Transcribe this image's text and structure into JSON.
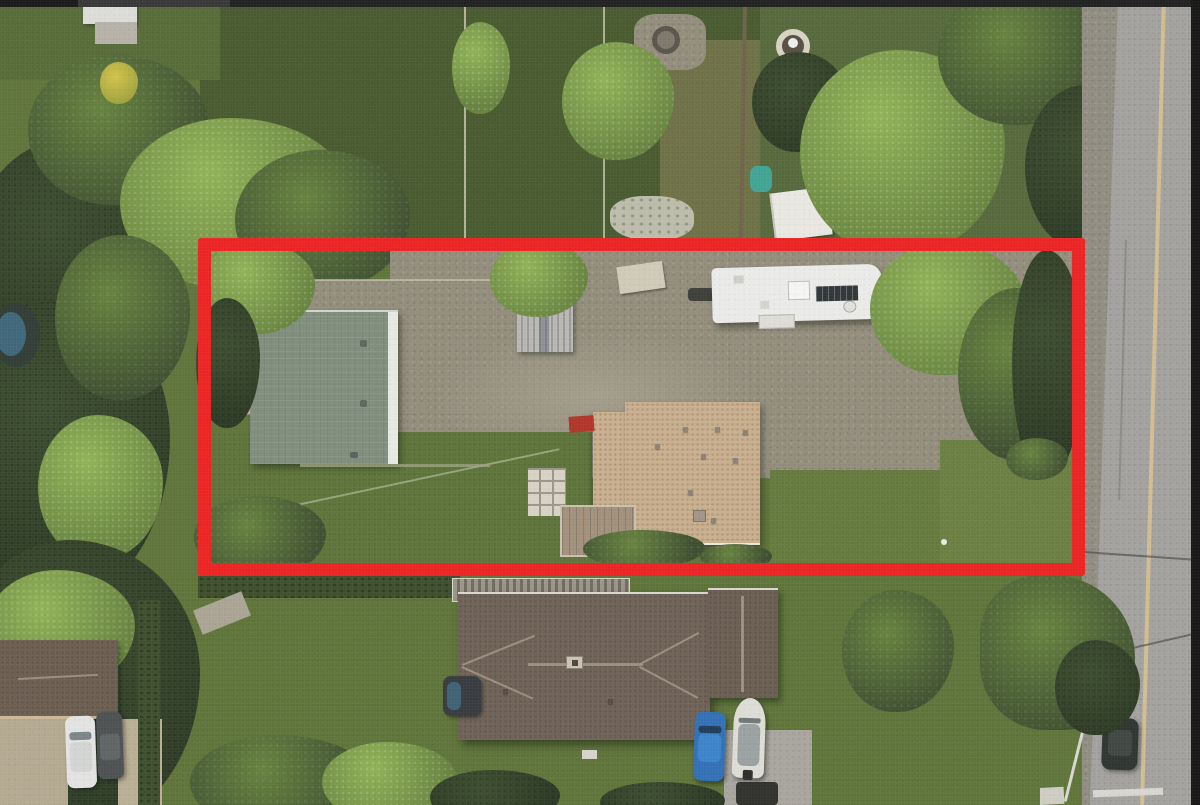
{
  "meta": {
    "description": "Top-down aerial drone photograph of a residential property lot outlined with a thick red rectangle; green-roof house and tan-roof house inside the lot with gravel driveway, metal shed and white RV trailer; large brown-roof house below; road with faded yellow center line on the right; dense trees and lawns around",
    "annotation": "red rectangular property boundary overlay"
  },
  "palette": {
    "letterbox": "#1e1e1e",
    "grassBase": "#5d7338",
    "grassDark": "#47592d",
    "grassPale": "#6f8344",
    "treeBright": "#8fb154",
    "treeMid": "#64803c",
    "treeDark": "#3b4c2d",
    "treeDarker": "#2a3823",
    "treeYellow": "#d2c247",
    "gravel": "#928c7b",
    "gravelLight": "#a39c8a",
    "road": "#a3a19e",
    "roadLine": "#d9c28c",
    "red": "#ec2121",
    "roofGreen": "#7e8c7b",
    "roofGreenTrim": "#e6e8e2",
    "roofTan": "#c8ae8d",
    "roofBrown": "#6e6156",
    "ridgeLight": "#9b8d7d",
    "rvWhite": "#eaeae8",
    "shedMetal": "#b4b3af",
    "deckWood": "#a08f7a",
    "concrete": "#a8a59d",
    "paver": "#d6d2c4",
    "hedge": "#3c4d2b",
    "poolBlue": "#41708a",
    "carBlue": "#2f6fb4",
    "carWhite": "#e3e3e1",
    "carGray": "#4b4f50",
    "carDarkRoad": "#2c322e",
    "boatWhite": "#dddcd5",
    "tealTarp": "#3fa392",
    "tentWhite": "#e9e7e1",
    "stoneGarden": "#bcbcab",
    "redObject": "#b03226",
    "solarPanel": "#2e3336",
    "whiteMark": "#d8d6d0"
  },
  "objects": {
    "red_boundary": "red rectangle outlining the listed lot",
    "green_roof_house": "house with sage green roof and white trim, left of lot",
    "tan_roof_house": "house with tan speckled roof, center of lot",
    "rv_trailer": "white RV trailer with solar panel, upper right of lot",
    "metal_shed": "corrugated metal shed under tree",
    "gravel_driveway": "large gravel parking area across the lot",
    "bottom_house": "large brown hip-roof house with garage, below lot",
    "blue_car": "blue car parked beside bottom house",
    "boat": "white boat on trailer beside bottom house",
    "white_car": "white car in lower-left neighbor driveway",
    "gray_car": "dark gray car in lower-left neighbor driveway",
    "road": "asphalt road with faded yellow center line, right edge",
    "parked_car_road": "dark car parked on road, lower right",
    "hot_tub": "covered hot tub left of bottom house",
    "fountain": "round stone garden feature, top lawn",
    "stone_garden": "stone garden patch, upper backyard",
    "white_tent": "white canopy tent, upper right backyard",
    "teal_tarp": "teal tarp beside tent",
    "pool": "partial above-ground pool at left edge",
    "fire_pit": "fire pit on gravel patch, top backyard"
  }
}
